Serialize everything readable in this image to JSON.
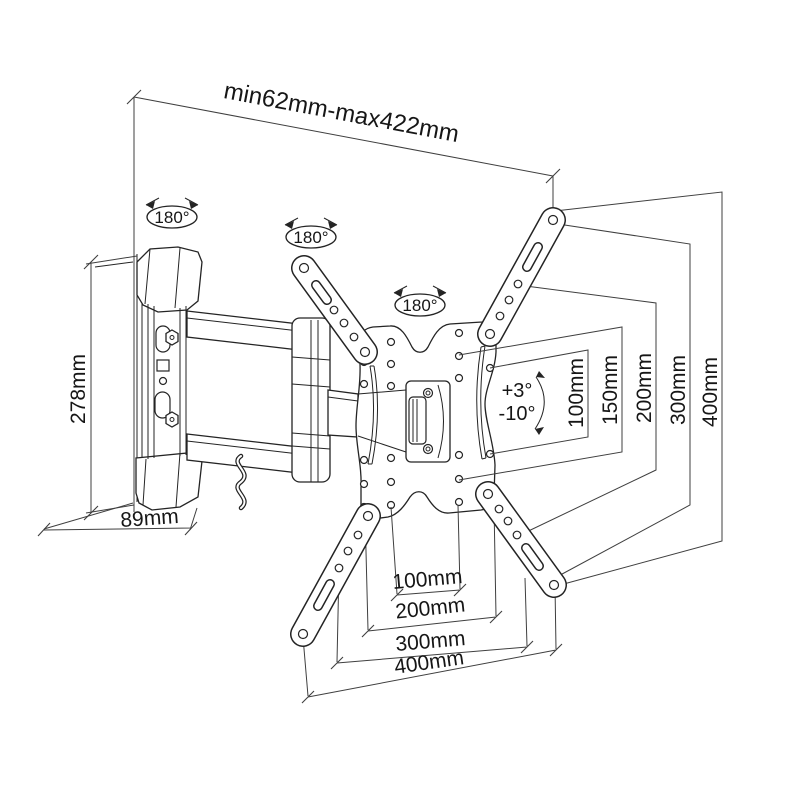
{
  "diagram": {
    "labels": {
      "top_range": "min62mm-max422mm",
      "rotation_wall": "180°",
      "rotation_elbow": "180°",
      "rotation_plate": "180°",
      "tilt_up": "+3°",
      "tilt_down": "-10°",
      "height": "278mm",
      "depth": "89mm"
    },
    "vesa_vertical": [
      "100mm",
      "150mm",
      "200mm",
      "300mm",
      "400mm"
    ],
    "vesa_horizontal": [
      "100mm",
      "200mm",
      "300mm",
      "400mm"
    ],
    "colors": {
      "line": "#2a2a2a",
      "background": "#ffffff"
    }
  }
}
